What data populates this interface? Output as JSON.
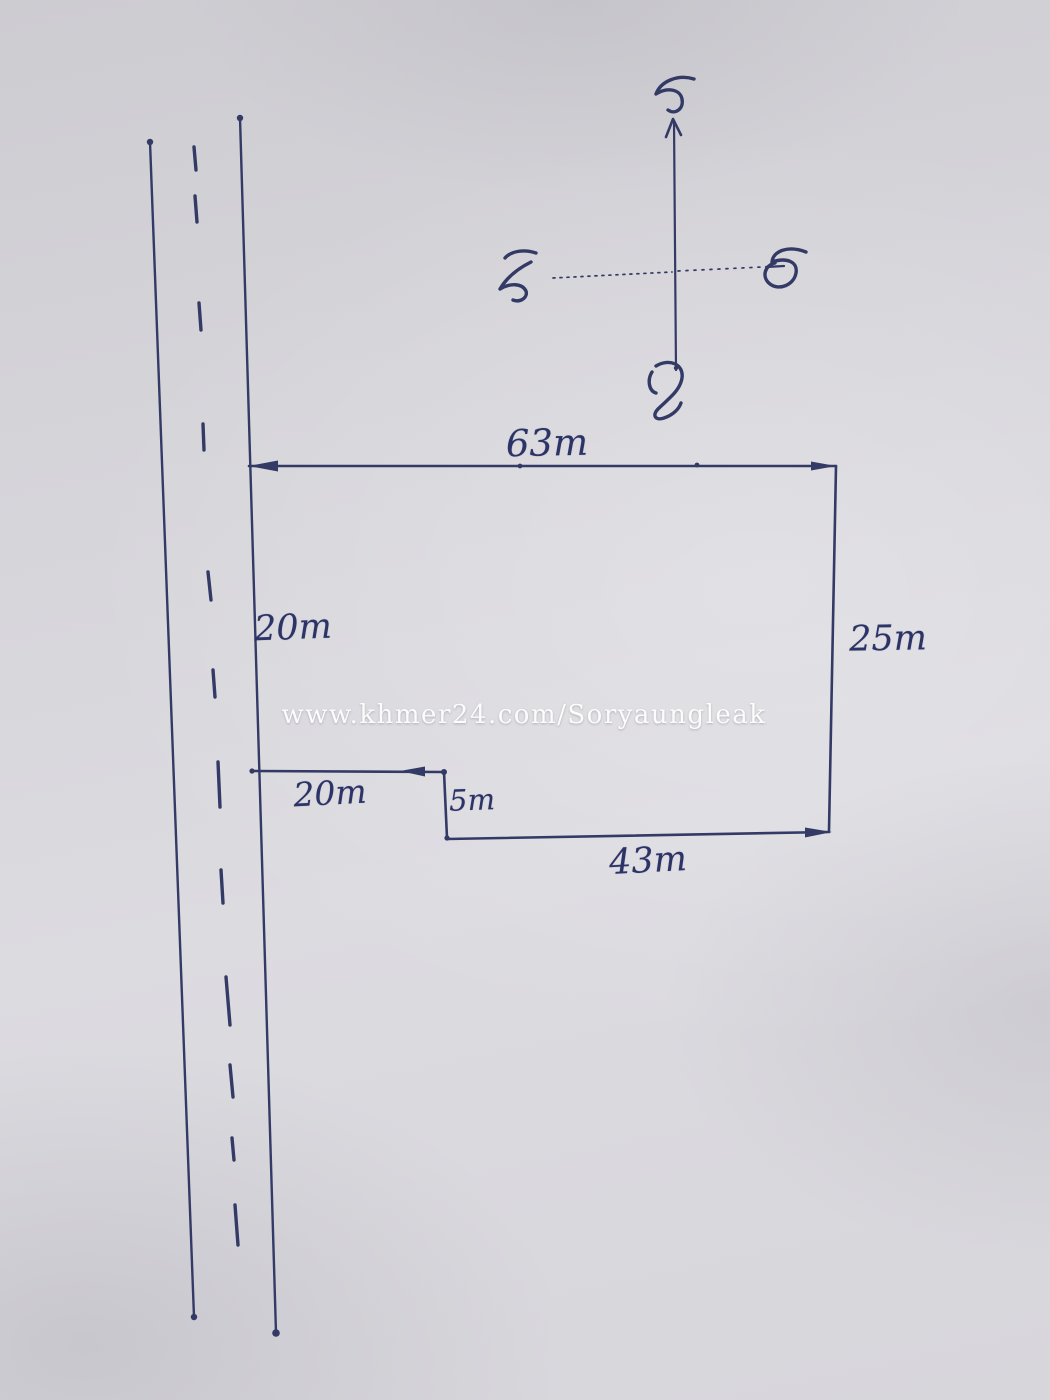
{
  "artwork": {
    "kind": "hand-drawn land plot sketch on paper",
    "ink_color": "#333a66",
    "paper_color": "#d6d5da"
  },
  "watermark": {
    "text": "www.khmer24.com/Soryaungleak",
    "color": "#ffffff"
  },
  "compass": {
    "north": {
      "khmer": "ជ"
    },
    "south": {
      "khmer": "ត្ប"
    },
    "east": {
      "khmer": "ក"
    },
    "west": {
      "khmer": "លិ"
    }
  },
  "dimensions": {
    "top_side": "63m",
    "left_side": "20m",
    "right_side": "25m",
    "step_width": "20m",
    "step_height": "5m",
    "bottom_side": "43m"
  }
}
